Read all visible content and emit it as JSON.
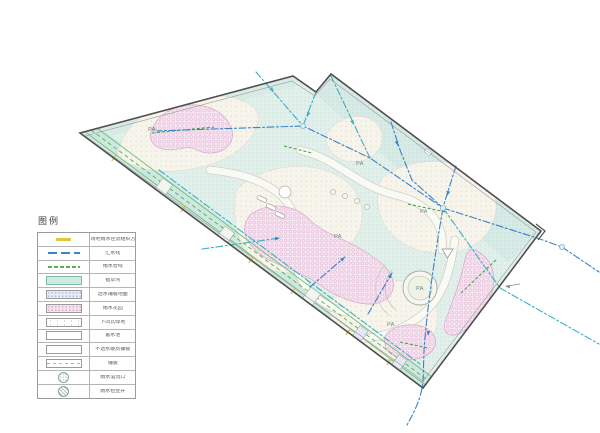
{
  "legend": {
    "title": "图例",
    "items": [
      {
        "label": "场地雨水径流组织方向",
        "symbol": "runoff-direction"
      },
      {
        "label": "汇水线",
        "symbol": "catchment-line"
      },
      {
        "label": "雨水管线",
        "symbol": "rain-pipe"
      },
      {
        "label": "植草沟",
        "symbol": "grass-swale"
      },
      {
        "label": "透水铺装地面",
        "symbol": "permeable-paving"
      },
      {
        "label": "雨水花园",
        "symbol": "rain-garden"
      },
      {
        "label": "下凹式绿地",
        "symbol": "sunken-green"
      },
      {
        "label": "蓄水池",
        "symbol": "storage-tank"
      },
      {
        "label": "不透水硬质铺装",
        "symbol": "impervious-paving"
      },
      {
        "label": "铺装",
        "symbol": "paving"
      },
      {
        "label": "雨水溢流口",
        "symbol": "overflow-outlet"
      },
      {
        "label": "雨水检查井",
        "symbol": "inspection-well"
      }
    ]
  },
  "plan": {
    "area_label": "PA",
    "colors": {
      "boundary": "#4f4f4f",
      "paving_cyan": "#e2f0ec",
      "plaza": "#f6f4eb",
      "rain_garden_pink": "#f7e5f1",
      "flow_line_blue": "#3b82c4",
      "flow_line_teal": "#3aafc4",
      "pipe_green": "#3f9e3f",
      "swale_green": "#6fbf73",
      "runoff_yellow": "#e3c43c"
    }
  }
}
